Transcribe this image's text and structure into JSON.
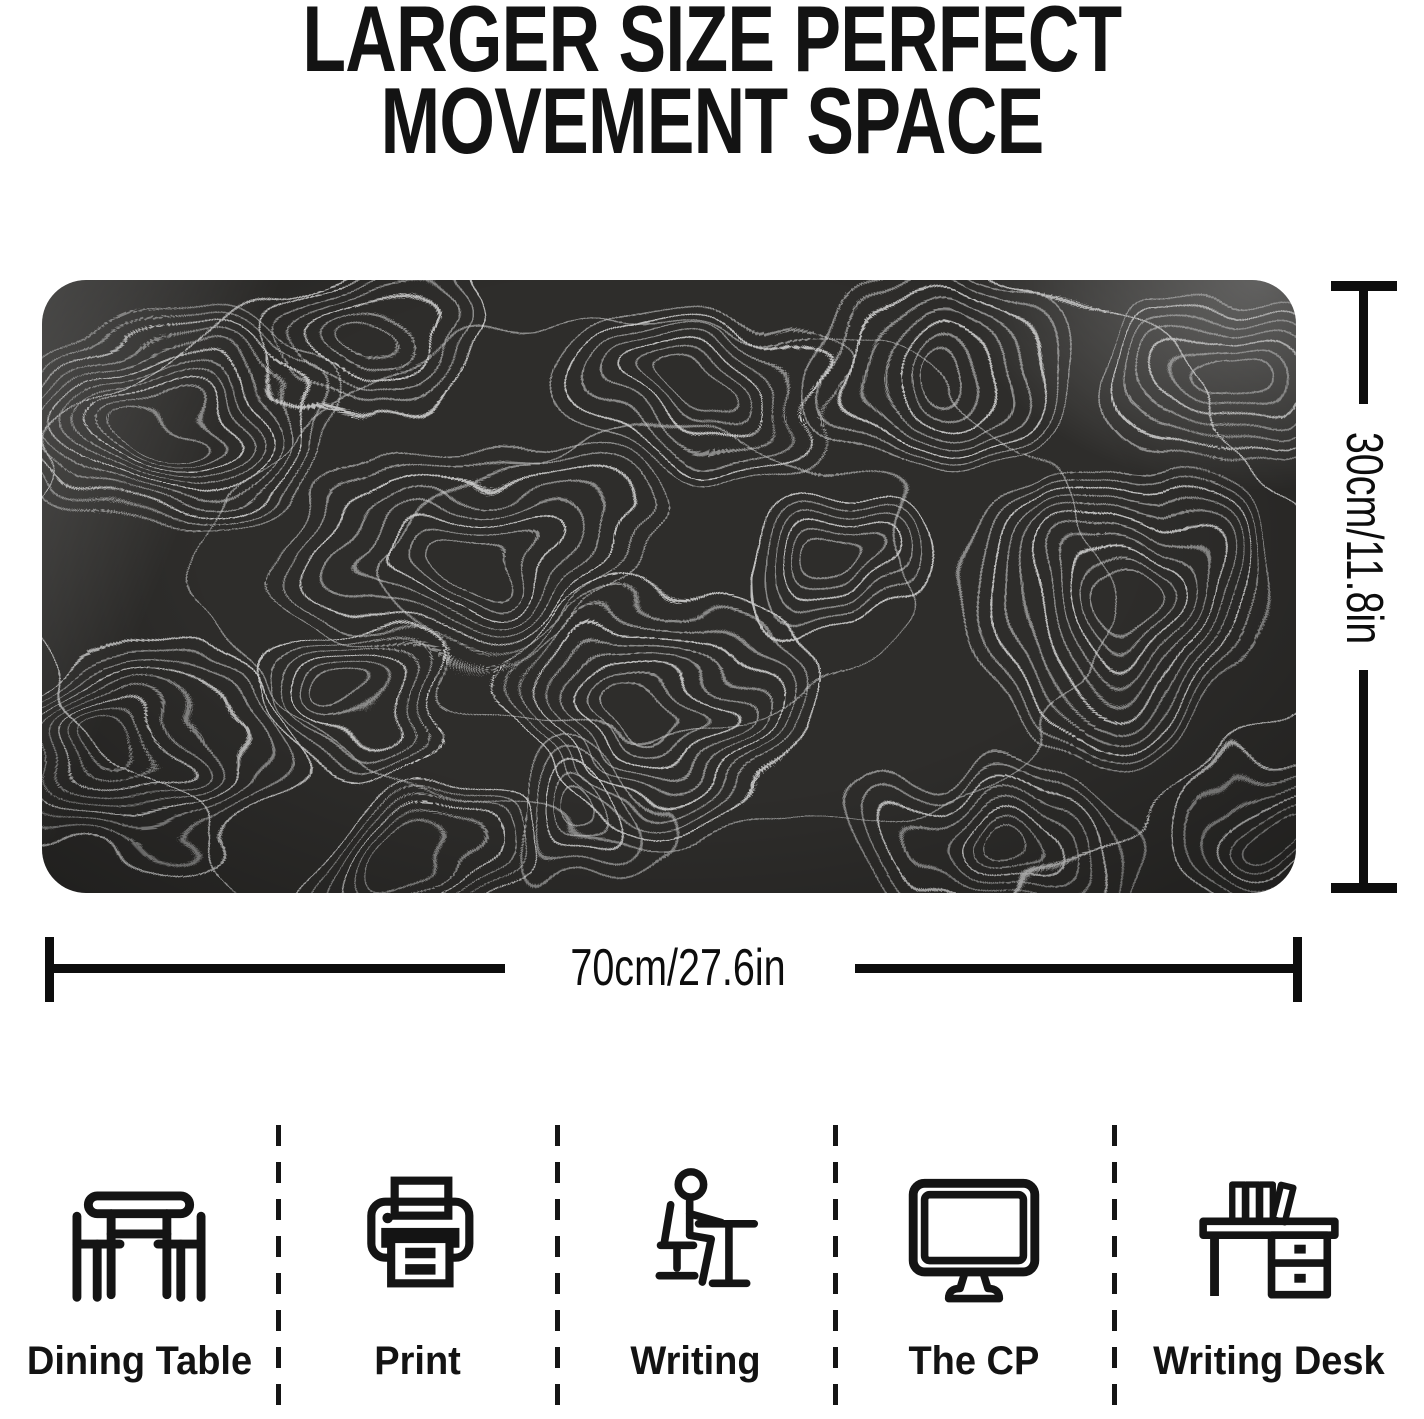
{
  "title": {
    "line1": "LARGER SIZE PERFECT",
    "line2": "MOVEMENT SPACE"
  },
  "mat": {
    "description": "Black extended desk mat with white topographic contour line pattern",
    "width_label": "70cm/27.6in",
    "height_label": "30cm/11.8in"
  },
  "features": {
    "items": [
      {
        "label": "Dining Table",
        "icon": "dining-table-icon"
      },
      {
        "label": "Print",
        "icon": "printer-icon"
      },
      {
        "label": "Writing",
        "icon": "person-writing-icon"
      },
      {
        "label": "The CP",
        "icon": "computer-monitor-icon"
      },
      {
        "label": "Writing Desk",
        "icon": "writing-desk-icon"
      }
    ]
  },
  "colors": {
    "mat_base": "#2e2d2b",
    "contour_line": "#c9c9c9",
    "ink": "#111111",
    "background": "#ffffff"
  }
}
